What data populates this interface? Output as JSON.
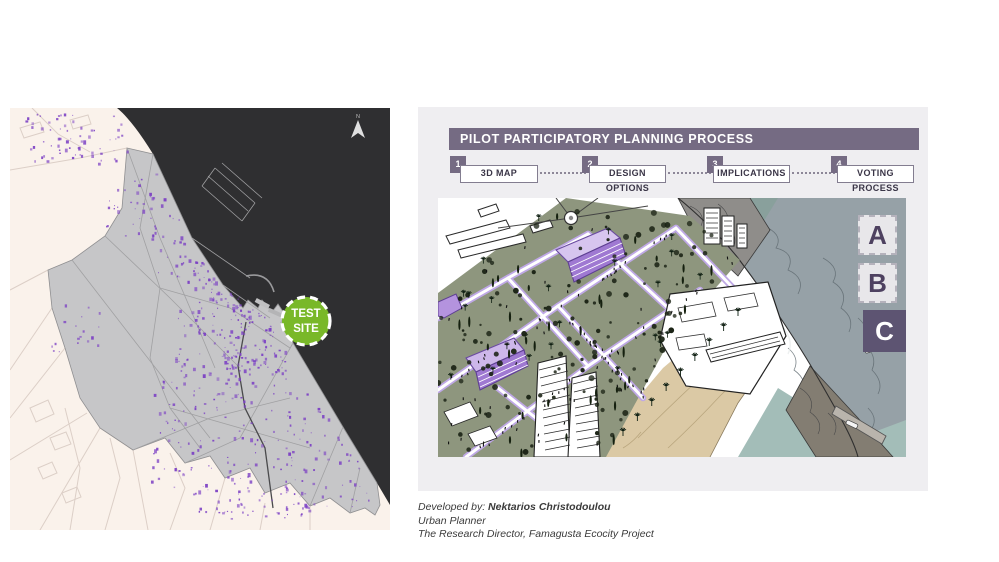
{
  "map": {
    "north_label": "N",
    "test_site": {
      "line1": "TEST",
      "line2": "SITE"
    },
    "colors": {
      "land": "#faf2eb",
      "land_roads": "#dccfc7",
      "urban": "#c6c6c8",
      "urban_border": "#8f8f91",
      "urban_roads": "#a0a0a2",
      "main_road": "#4a4a4c",
      "sea": "#2f2f31",
      "purple_buildings": "#7b3fc4",
      "test_site_green": "#79b829",
      "north_arrow": "#e0e0e0"
    }
  },
  "panel": {
    "title": "PILOT PARTICIPATORY PLANNING PROCESS",
    "title_bg": "#756b83",
    "steps": [
      {
        "number": "1",
        "label": "3D MAP"
      },
      {
        "number": "2",
        "label": "DESIGN OPTIONS"
      },
      {
        "number": "3",
        "label": "IMPLICATIONS"
      },
      {
        "number": "4",
        "label": "VOTING PROCESS"
      }
    ],
    "options": [
      {
        "label": "A",
        "selected": false
      },
      {
        "label": "B",
        "selected": false
      },
      {
        "label": "C",
        "selected": true
      }
    ],
    "illustration_colors": {
      "lawn": "#8e967e",
      "path_edge": "#bfa8e6",
      "purple_building": "#9f79d2",
      "beach": "#dbc9a5",
      "sea": "#96a1a7",
      "sea_shallow": "#a3bdb8",
      "rock": "#8f8d8a"
    }
  },
  "credits": {
    "prefix": "Developed by: ",
    "name": "Nektarios Christodoulou",
    "role": "Urban Planner",
    "title_line": "The Research Director, Famagusta Ecocity Project"
  }
}
